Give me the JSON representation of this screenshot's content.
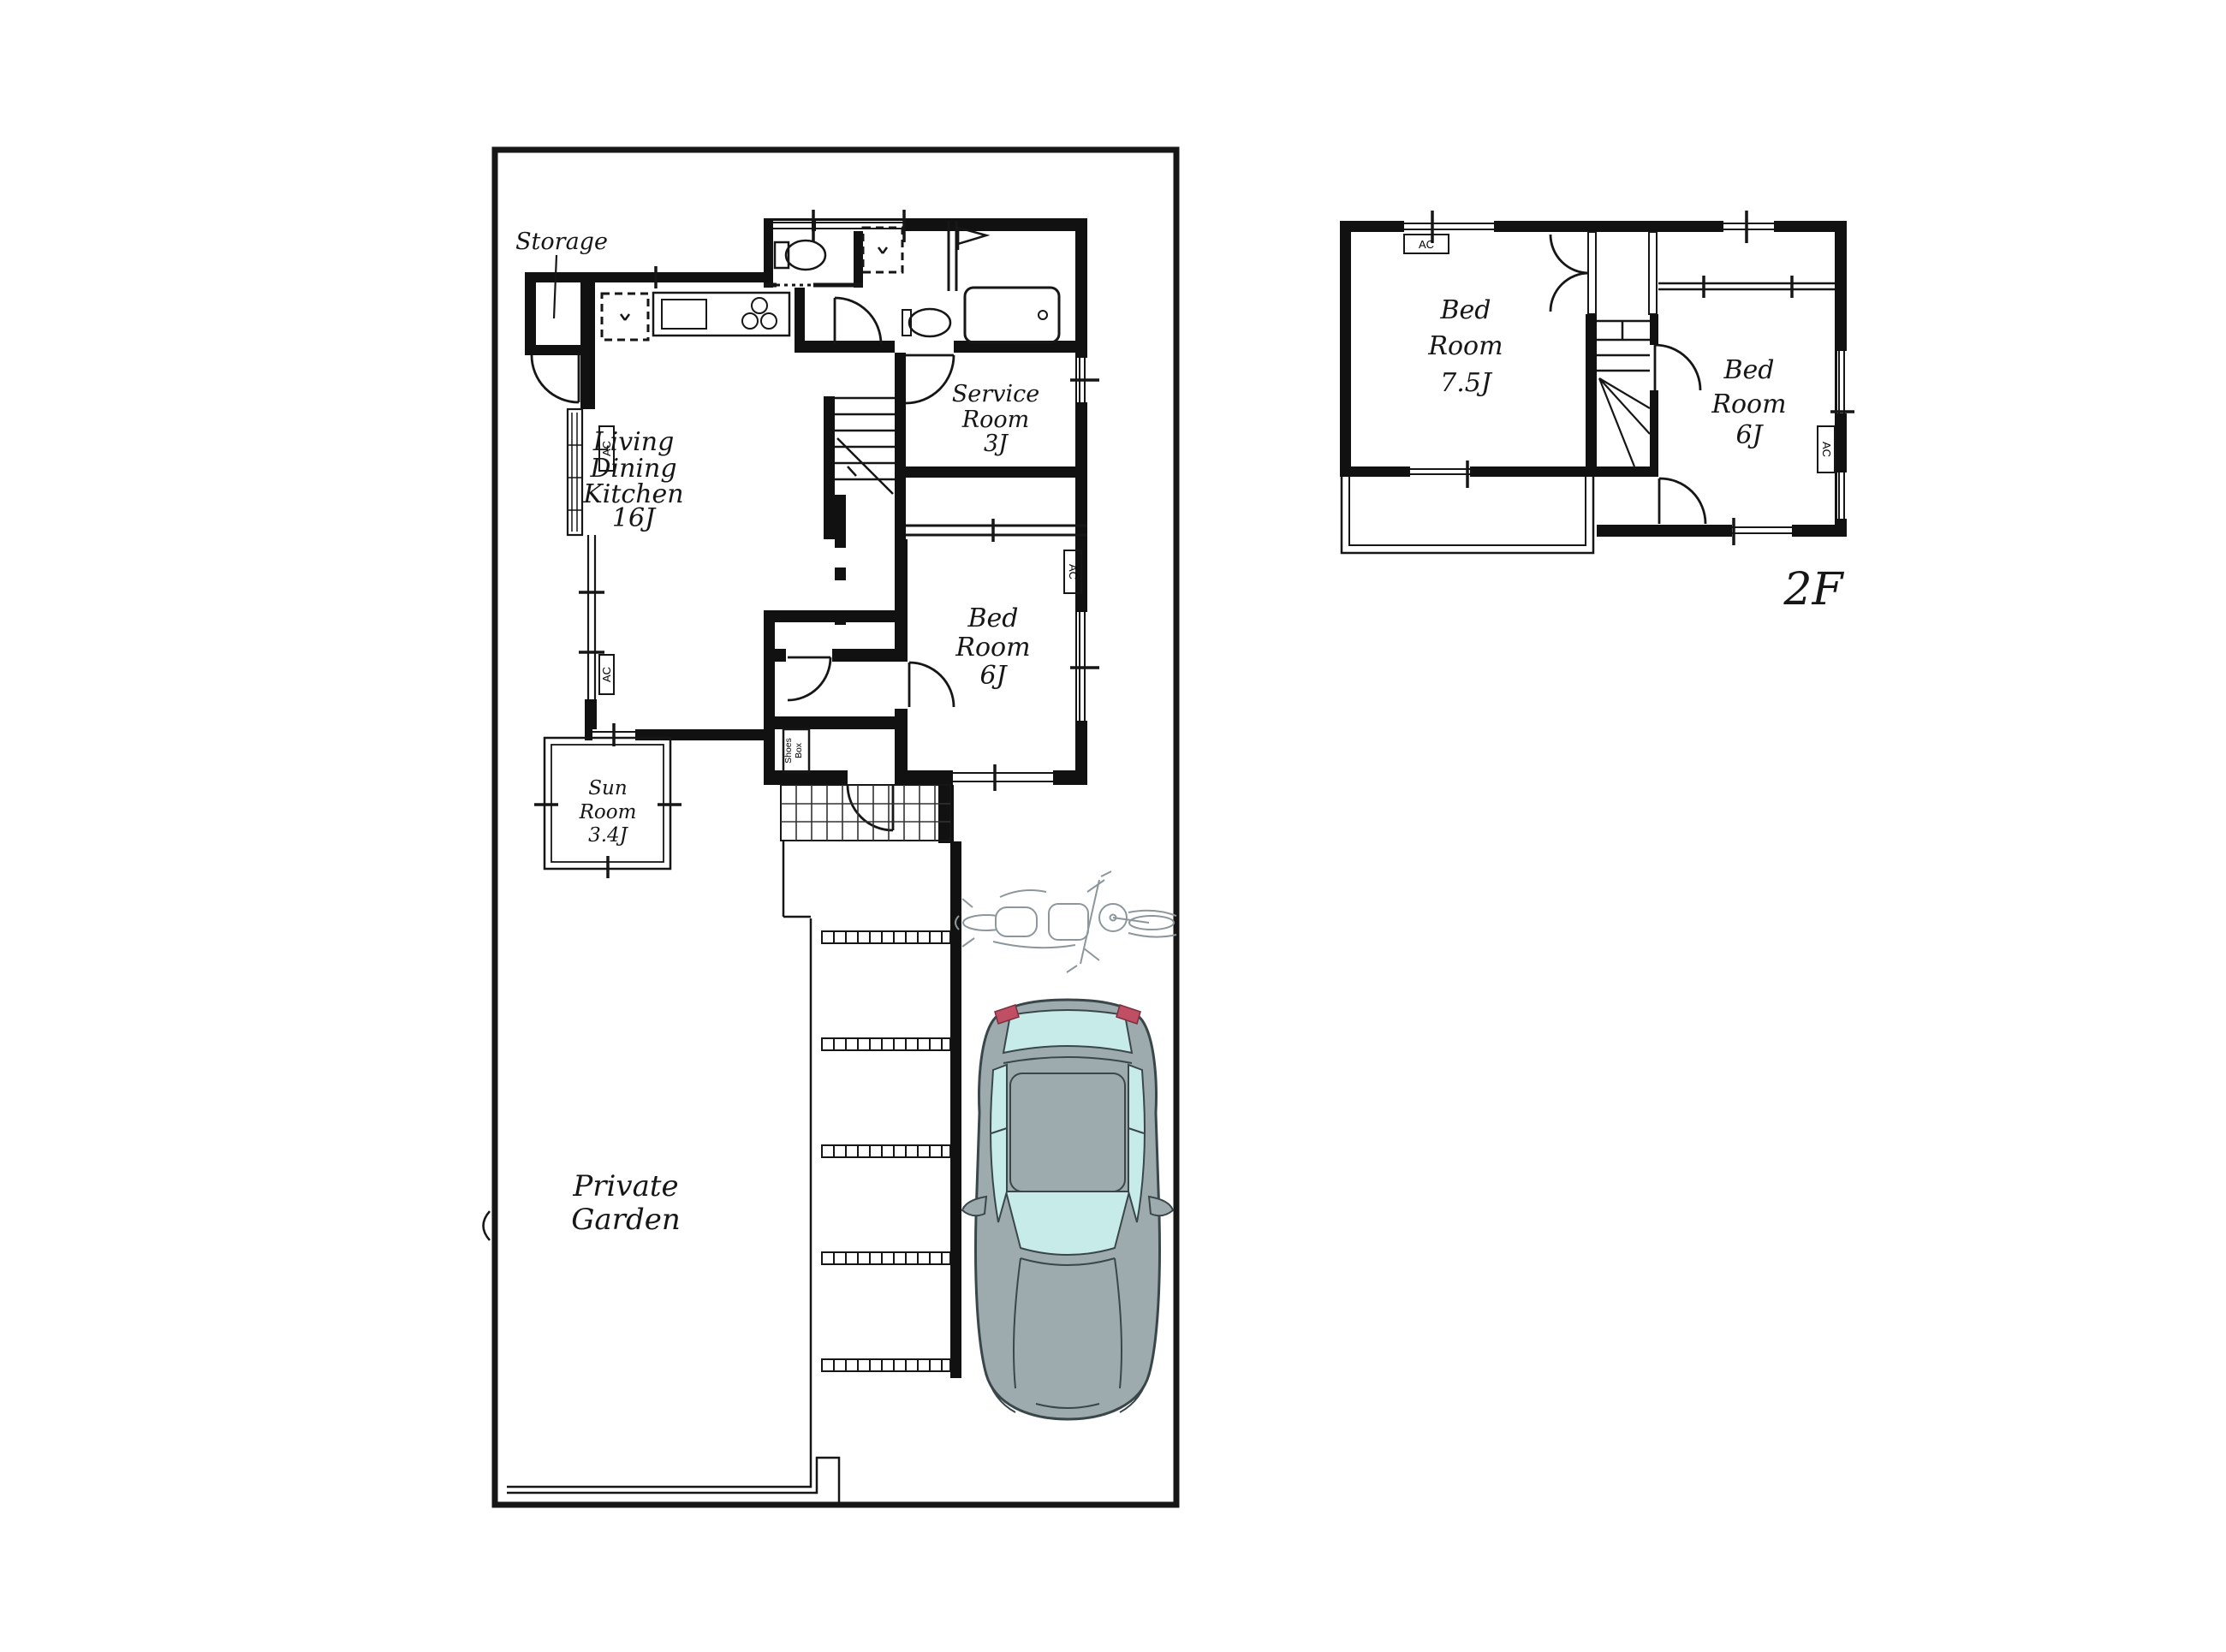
{
  "floor1": {
    "storage": "Storage",
    "ldk": {
      "lines": [
        "Living",
        "Dining",
        "Kitchen",
        "16J"
      ]
    },
    "service_room": {
      "lines": [
        "Service",
        "Room",
        "3J"
      ]
    },
    "bed_room": {
      "lines": [
        "Bed",
        "Room",
        "6J"
      ]
    },
    "sun_room": {
      "lines": [
        "Sun",
        "Room",
        "3.4J"
      ]
    },
    "shoes_box": {
      "lines": [
        "Shoes",
        "Box"
      ]
    },
    "private_garden": {
      "lines": [
        "Private",
        "Garden"
      ]
    },
    "ac": "AC"
  },
  "floor2": {
    "label": "2F",
    "bed_room_75": {
      "lines": [
        "Bed",
        "Room",
        "7.5J"
      ]
    },
    "bed_room_6": {
      "lines": [
        "Bed",
        "Room",
        "6J"
      ]
    },
    "ac": "AC"
  },
  "colors": {
    "wall": "#111111",
    "car_body": "#9dabaf",
    "car_window": "#c7ebe8",
    "car_accent": "#c04f63",
    "car_outline": "#39464a",
    "sketch": "#8d979b"
  }
}
